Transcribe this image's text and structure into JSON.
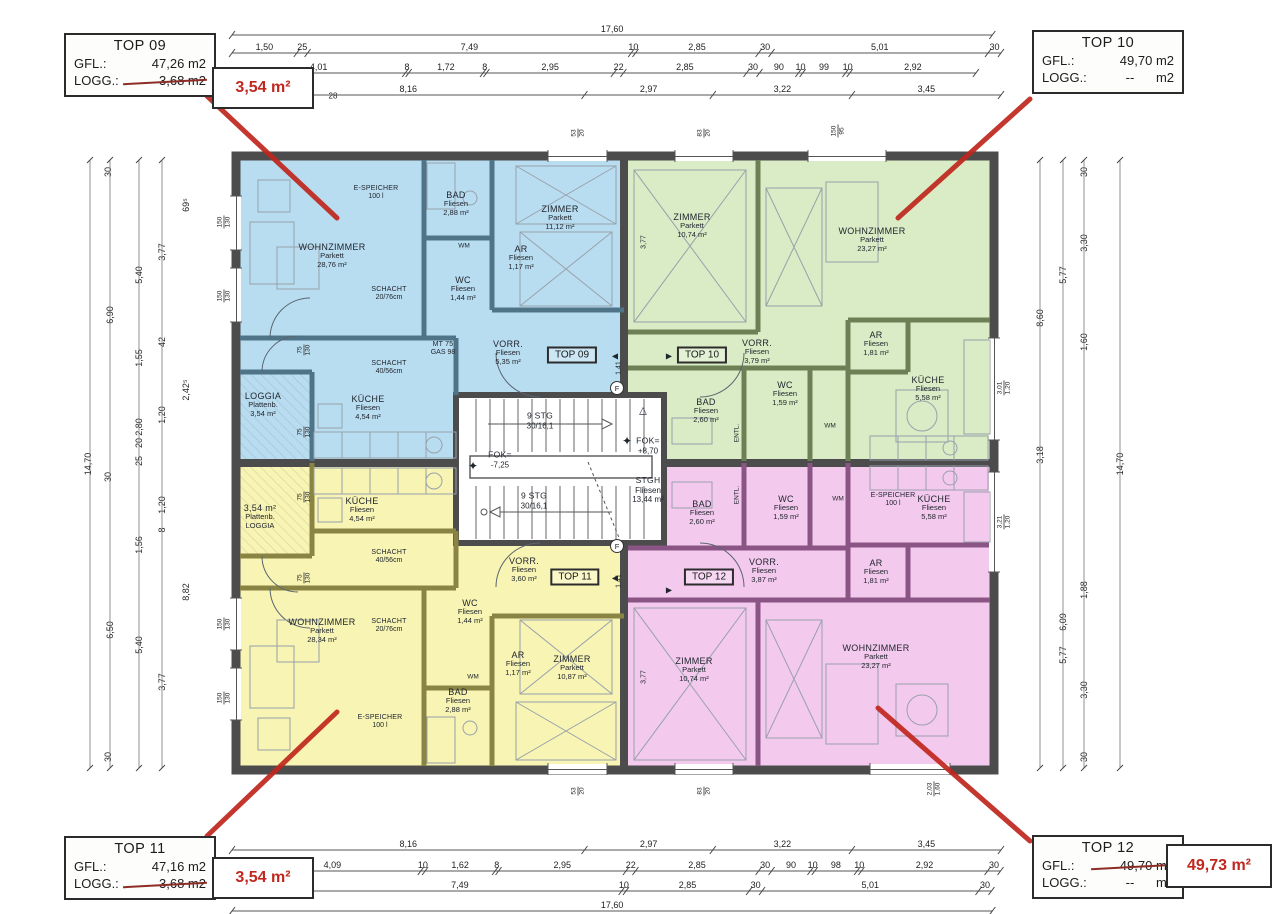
{
  "colors": {
    "accent_red": "#c0271e",
    "blue_fill": "#b9ddf0",
    "green_fill": "#d9ecc5",
    "yellow_fill": "#f8f4b3",
    "pink_fill": "#f4c9ee"
  },
  "annotations": {
    "boxes": [
      {
        "id": "top09",
        "title": "TOP 09",
        "x": 64,
        "y": 33,
        "w": 152,
        "h": 64,
        "rows": [
          {
            "label": "GFL.:",
            "value": "47,26 m2",
            "struck": false
          },
          {
            "label": "LOGG.:",
            "value": "3,68 m2",
            "struck": true
          }
        ]
      },
      {
        "id": "top10",
        "title": "TOP 10",
        "x": 1032,
        "y": 30,
        "w": 152,
        "h": 64,
        "rows": [
          {
            "label": "GFL.:",
            "value": "49,70 m2",
            "struck": false
          },
          {
            "label": "LOGG.:",
            "value": "--      m2",
            "struck": false
          }
        ]
      },
      {
        "id": "top11",
        "title": "TOP 11",
        "x": 64,
        "y": 836,
        "w": 152,
        "h": 64,
        "rows": [
          {
            "label": "GFL.:",
            "value": "47,16 m2",
            "struck": false
          },
          {
            "label": "LOGG.:",
            "value": "3,68 m2",
            "struck": true
          }
        ]
      },
      {
        "id": "top12",
        "title": "TOP 12",
        "x": 1032,
        "y": 835,
        "w": 152,
        "h": 64,
        "rows": [
          {
            "label": "GFL.:",
            "value": "49,70 m2",
            "struck": true
          },
          {
            "label": "LOGG.:",
            "value": "--      m2",
            "struck": false
          }
        ]
      }
    ],
    "red_boxes": [
      {
        "id": "note09",
        "text": "3,54 m²",
        "x": 212,
        "y": 67,
        "w": 102,
        "h": 42
      },
      {
        "id": "note11",
        "text": "3,54 m²",
        "x": 212,
        "y": 857,
        "w": 102,
        "h": 42
      },
      {
        "id": "note12",
        "text": "49,73 m²",
        "x": 1166,
        "y": 844,
        "w": 106,
        "h": 44
      }
    ],
    "red_lines": [
      [
        207,
        96,
        337,
        218
      ],
      [
        1030,
        99,
        898,
        218
      ],
      [
        207,
        836,
        337,
        712
      ],
      [
        1030,
        841,
        878,
        708
      ]
    ]
  },
  "plan": {
    "unit_signs": [
      {
        "text": "TOP 09",
        "x": 572,
        "y": 355
      },
      {
        "text": "TOP 10",
        "x": 702,
        "y": 355
      },
      {
        "text": "TOP 11",
        "x": 575,
        "y": 577
      },
      {
        "text": "TOP 12",
        "x": 709,
        "y": 577
      }
    ],
    "f_letter": "F",
    "f_markers": [
      [
        617,
        388
      ],
      [
        617,
        546
      ]
    ],
    "labels": [
      {
        "lines": [
          "WOHNZIMMER",
          "Parkett",
          "28,76 m²"
        ],
        "x": 332,
        "y": 256
      },
      {
        "lines": [
          "ZIMMER",
          "Parkett",
          "11,12 m²"
        ],
        "x": 560,
        "y": 218
      },
      {
        "lines": [
          "BAD",
          "Fliesen",
          "2,88 m²"
        ],
        "x": 456,
        "y": 204
      },
      {
        "lines": [
          "AR",
          "Fliesen",
          "1,17 m²"
        ],
        "x": 521,
        "y": 258
      },
      {
        "lines": [
          "WC",
          "Fliesen",
          "1,44 m²"
        ],
        "x": 463,
        "y": 289
      },
      {
        "lines": [
          "VORR.",
          "Fliesen",
          "5,35 m²"
        ],
        "x": 508,
        "y": 353
      },
      {
        "lines": [
          "KÜCHE",
          "Fliesen",
          "4,54 m²"
        ],
        "x": 368,
        "y": 408
      },
      {
        "lines": [
          "LOGGIA",
          "Plattenb.",
          "3,54 m²"
        ],
        "x": 263,
        "y": 405
      },
      {
        "lines": [
          "ZIMMER",
          "Parkett",
          "10,74 m²"
        ],
        "x": 692,
        "y": 226
      },
      {
        "lines": [
          "WOHNZIMMER",
          "Parkett",
          "23,27 m²"
        ],
        "x": 872,
        "y": 240
      },
      {
        "lines": [
          "VORR.",
          "Fliesen",
          "3,79 m²"
        ],
        "x": 757,
        "y": 352
      },
      {
        "lines": [
          "BAD",
          "Fliesen",
          "2,60 m²"
        ],
        "x": 706,
        "y": 411
      },
      {
        "lines": [
          "WC",
          "Fliesen",
          "1,59 m²"
        ],
        "x": 785,
        "y": 394
      },
      {
        "lines": [
          "AR",
          "Fliesen",
          "1,81 m²"
        ],
        "x": 876,
        "y": 344
      },
      {
        "lines": [
          "KÜCHE",
          "Fliesen",
          "5,58 m²"
        ],
        "x": 928,
        "y": 389
      },
      {
        "lines": [
          "WOHNZIMMER",
          "Parkett",
          "28,34 m²"
        ],
        "x": 322,
        "y": 631
      },
      {
        "lines": [
          "ZIMMER",
          "Parkett",
          "10,87 m²"
        ],
        "x": 572,
        "y": 668
      },
      {
        "lines": [
          "BAD",
          "Fliesen",
          "2,88 m²"
        ],
        "x": 458,
        "y": 701
      },
      {
        "lines": [
          "AR",
          "Fliesen",
          "1,17 m²"
        ],
        "x": 518,
        "y": 664
      },
      {
        "lines": [
          "WC",
          "Fliesen",
          "1,44 m²"
        ],
        "x": 470,
        "y": 612
      },
      {
        "lines": [
          "VORR.",
          "Fliesen",
          "3,60 m²"
        ],
        "x": 524,
        "y": 570
      },
      {
        "lines": [
          "KÜCHE",
          "Fliesen",
          "4,54 m²"
        ],
        "x": 362,
        "y": 510
      },
      {
        "lines": [
          "3,54 m²",
          "Plattenb.",
          "LOGGIA"
        ],
        "x": 260,
        "y": 517
      },
      {
        "lines": [
          "ZIMMER",
          "Parkett",
          "10,74 m²"
        ],
        "x": 694,
        "y": 670
      },
      {
        "lines": [
          "WOHNZIMMER",
          "Parkett",
          "23,27 m²"
        ],
        "x": 876,
        "y": 657
      },
      {
        "lines": [
          "VORR.",
          "Fliesen",
          "3,87 m²"
        ],
        "x": 764,
        "y": 571
      },
      {
        "lines": [
          "BAD",
          "Fliesen",
          "2,60 m²"
        ],
        "x": 702,
        "y": 513
      },
      {
        "lines": [
          "WC",
          "Fliesen",
          "1,59 m²"
        ],
        "x": 786,
        "y": 508
      },
      {
        "lines": [
          "AR",
          "Fliesen",
          "1,81 m²"
        ],
        "x": 876,
        "y": 572
      },
      {
        "lines": [
          "KÜCHE",
          "Fliesen",
          "5,58 m²"
        ],
        "x": 934,
        "y": 508
      },
      {
        "lines": [
          "9 STG",
          "30/16,1"
        ],
        "x": 540,
        "y": 421,
        "cls": "stair"
      },
      {
        "lines": [
          "9 STG",
          "30/16,1"
        ],
        "x": 534,
        "y": 501,
        "cls": "stair"
      },
      {
        "lines": [
          "FOK=",
          "-7,25"
        ],
        "x": 500,
        "y": 460,
        "cls": "stair"
      },
      {
        "lines": [
          "FOK=",
          "+8,70"
        ],
        "x": 648,
        "y": 446,
        "cls": "stair"
      },
      {
        "lines": [
          "STGH",
          "Fliesen",
          "13,44 m²"
        ],
        "x": 648,
        "y": 490,
        "cls": "stair"
      },
      {
        "lines": [
          "E-SPEICHER",
          "100 l"
        ],
        "x": 376,
        "y": 193,
        "cls": "tiny"
      },
      {
        "lines": [
          "E-SPEICHER",
          "100 l"
        ],
        "x": 380,
        "y": 722,
        "cls": "tiny"
      },
      {
        "lines": [
          "E-SPEICHER",
          "100 l"
        ],
        "x": 893,
        "y": 500,
        "cls": "tiny"
      },
      {
        "lines": [
          "SCHACHT",
          "20/76cm"
        ],
        "x": 389,
        "y": 294,
        "cls": "tiny"
      },
      {
        "lines": [
          "SCHACHT",
          "40/56cm"
        ],
        "x": 389,
        "y": 368,
        "cls": "tiny"
      },
      {
        "lines": [
          "SCHACHT",
          "40/56cm"
        ],
        "x": 389,
        "y": 557,
        "cls": "tiny"
      },
      {
        "lines": [
          "SCHACHT",
          "20/76cm"
        ],
        "x": 389,
        "y": 626,
        "cls": "tiny"
      },
      {
        "lines": [
          "MT 75",
          "GAS 98"
        ],
        "x": 443,
        "y": 349,
        "cls": "tiny"
      }
    ],
    "small": [
      {
        "t": "ENTL.",
        "x": 737,
        "y": 433,
        "rot": -90,
        "fs": 6.5
      },
      {
        "t": "ENTL.",
        "x": 737,
        "y": 495,
        "rot": -90,
        "fs": 6.5
      },
      {
        "t": "WM",
        "x": 464,
        "y": 246,
        "fs": 6.5
      },
      {
        "t": "WM",
        "x": 473,
        "y": 677,
        "fs": 6.5
      },
      {
        "t": "WM",
        "x": 830,
        "y": 426,
        "fs": 6.5
      },
      {
        "t": "WM",
        "x": 838,
        "y": 499,
        "fs": 6.5
      },
      {
        "t": "28",
        "x": 333,
        "y": 96,
        "fs": 8
      },
      {
        "t": "1,41",
        "x": 619,
        "y": 368,
        "rot": -90,
        "fs": 7
      },
      {
        "t": "1,41",
        "x": 619,
        "y": 581,
        "rot": -90,
        "fs": 7
      },
      {
        "t": "3,77",
        "x": 644,
        "y": 242,
        "rot": -90,
        "fs": 7
      },
      {
        "t": "3,77",
        "x": 644,
        "y": 677,
        "rot": -90,
        "fs": 7
      },
      {
        "t": "△",
        "x": 643,
        "y": 411,
        "fs": 10
      },
      {
        "t": "✦",
        "x": 473,
        "y": 466,
        "fs": 12
      },
      {
        "t": "✦",
        "x": 627,
        "y": 441,
        "fs": 12
      },
      {
        "t": "◀",
        "x": 615,
        "y": 356,
        "fs": 8
      },
      {
        "t": "▶",
        "x": 669,
        "y": 356,
        "fs": 8
      },
      {
        "t": "◀",
        "x": 615,
        "y": 578,
        "fs": 8
      },
      {
        "t": "▶",
        "x": 669,
        "y": 590,
        "fs": 8
      }
    ],
    "window_labels": [
      {
        "lines": [
          "150",
          "130"
        ],
        "x": 224,
        "y": 222
      },
      {
        "lines": [
          "150",
          "130"
        ],
        "x": 224,
        "y": 296
      },
      {
        "lines": [
          "150",
          "130"
        ],
        "x": 224,
        "y": 624
      },
      {
        "lines": [
          "150",
          "130"
        ],
        "x": 224,
        "y": 698
      },
      {
        "lines": [
          "3,01",
          "1,20"
        ],
        "x": 1004,
        "y": 388
      },
      {
        "lines": [
          "3,21",
          "1,20"
        ],
        "x": 1004,
        "y": 522
      },
      {
        "lines": [
          "53",
          "20"
        ],
        "x": 578,
        "y": 133
      },
      {
        "lines": [
          "83",
          "20"
        ],
        "x": 704,
        "y": 133
      },
      {
        "lines": [
          "150",
          "95"
        ],
        "x": 838,
        "y": 131
      },
      {
        "lines": [
          "53",
          "20"
        ],
        "x": 578,
        "y": 791
      },
      {
        "lines": [
          "83",
          "20"
        ],
        "x": 704,
        "y": 791
      },
      {
        "lines": [
          "2,03",
          "1,60"
        ],
        "x": 934,
        "y": 789
      },
      {
        "lines": [
          "75",
          "130"
        ],
        "x": 304,
        "y": 350
      },
      {
        "lines": [
          "75",
          "130"
        ],
        "x": 304,
        "y": 432
      },
      {
        "lines": [
          "75",
          "130"
        ],
        "x": 304,
        "y": 497
      },
      {
        "lines": [
          "75",
          "130"
        ],
        "x": 304,
        "y": 578
      }
    ]
  },
  "dimensions": {
    "k": 43.2,
    "x0": 232,
    "h_rows": [
      {
        "y": 30,
        "segs": [
          {
            "t": "17,60",
            "v": 17.6
          }
        ]
      },
      {
        "y": 48,
        "segs": [
          {
            "t": "1,50",
            "v": 1.5
          },
          {
            "t": "25",
            "v": 0.25
          },
          {
            "t": "7,49",
            "v": 7.49
          },
          {
            "t": "10",
            "v": 0.1
          },
          {
            "t": "2,85",
            "v": 2.85
          },
          {
            "t": "30",
            "v": 0.3
          },
          {
            "t": "5,01",
            "v": 5.01
          },
          {
            "t": "30",
            "v": 0.3
          }
        ]
      },
      {
        "y": 68,
        "segs": [
          {
            "t": "4,01",
            "v": 4.01
          },
          {
            "t": "8",
            "v": 0.08
          },
          {
            "t": "1,72",
            "v": 1.72
          },
          {
            "t": "8",
            "v": 0.08
          },
          {
            "t": "2,95",
            "v": 2.95
          },
          {
            "t": "22",
            "v": 0.22
          },
          {
            "t": "2,85",
            "v": 2.85
          },
          {
            "t": "30",
            "v": 0.3
          },
          {
            "t": "90",
            "v": 0.9
          },
          {
            "t": "10",
            "v": 0.1
          },
          {
            "t": "99",
            "v": 0.99
          },
          {
            "t": "10",
            "v": 0.1
          },
          {
            "t": "2,92",
            "v": 2.92
          }
        ]
      },
      {
        "y": 90,
        "segs": [
          {
            "t": "8,16",
            "v": 8.16
          },
          {
            "t": "2,97",
            "v": 2.97
          },
          {
            "t": "3,22",
            "v": 3.22
          },
          {
            "t": "3,45",
            "v": 3.45
          }
        ]
      },
      {
        "y": 845,
        "segs": [
          {
            "t": "8,16",
            "v": 8.16
          },
          {
            "t": "2,97",
            "v": 2.97
          },
          {
            "t": "3,22",
            "v": 3.22
          },
          {
            "t": "3,45",
            "v": 3.45
          }
        ]
      },
      {
        "y": 866,
        "segs": [
          {
            "t": "28",
            "v": 0.28
          },
          {
            "t": "4,09",
            "v": 4.09
          },
          {
            "t": "10",
            "v": 0.1
          },
          {
            "t": "1,62",
            "v": 1.62
          },
          {
            "t": "8",
            "v": 0.08
          },
          {
            "t": "2,95",
            "v": 2.95
          },
          {
            "t": "22",
            "v": 0.22
          },
          {
            "t": "2,85",
            "v": 2.85
          },
          {
            "t": "30",
            "v": 0.3
          },
          {
            "t": "90",
            "v": 0.9
          },
          {
            "t": "10",
            "v": 0.1
          },
          {
            "t": "98",
            "v": 0.98
          },
          {
            "t": "10",
            "v": 0.1
          },
          {
            "t": "2,92",
            "v": 2.92
          },
          {
            "t": "30",
            "v": 0.3
          }
        ]
      },
      {
        "y": 886,
        "segs": [
          {
            "t": "",
            "v": 1.28
          },
          {
            "t": "25",
            "v": 0.25
          },
          {
            "t": "7,49",
            "v": 7.49
          },
          {
            "t": "10",
            "v": 0.1
          },
          {
            "t": "2,85",
            "v": 2.85
          },
          {
            "t": "30",
            "v": 0.3
          },
          {
            "t": "5,01",
            "v": 5.01
          },
          {
            "t": "30",
            "v": 0.3
          }
        ]
      },
      {
        "y": 906,
        "segs": [
          {
            "t": "17,60",
            "v": 17.6
          }
        ]
      }
    ],
    "v_lines": [
      90,
      110,
      139,
      162,
      1040,
      1063,
      1084,
      1120
    ],
    "v_labels": [
      {
        "t": "30",
        "x": 108,
        "y": 172
      },
      {
        "t": "69⁵",
        "x": 186,
        "y": 205
      },
      {
        "t": "3,77",
        "x": 162,
        "y": 252
      },
      {
        "t": "5,40",
        "x": 139,
        "y": 275
      },
      {
        "t": "6,90",
        "x": 110,
        "y": 315
      },
      {
        "t": "42",
        "x": 162,
        "y": 342
      },
      {
        "t": "1,55",
        "x": 139,
        "y": 358
      },
      {
        "t": "2,42⁵",
        "x": 186,
        "y": 390
      },
      {
        "t": "1,20",
        "x": 162,
        "y": 415
      },
      {
        "t": "2,80",
        "x": 139,
        "y": 427
      },
      {
        "t": "20",
        "x": 139,
        "y": 443
      },
      {
        "t": "25",
        "x": 139,
        "y": 461
      },
      {
        "t": "14,70",
        "x": 88,
        "y": 464
      },
      {
        "t": "30",
        "x": 108,
        "y": 477
      },
      {
        "t": "1,20",
        "x": 162,
        "y": 505
      },
      {
        "t": "8",
        "x": 162,
        "y": 530
      },
      {
        "t": "1,56",
        "x": 139,
        "y": 545
      },
      {
        "t": "8,82",
        "x": 186,
        "y": 592
      },
      {
        "t": "6,50",
        "x": 110,
        "y": 630
      },
      {
        "t": "5,40",
        "x": 139,
        "y": 645
      },
      {
        "t": "3,77",
        "x": 162,
        "y": 682
      },
      {
        "t": "30",
        "x": 108,
        "y": 757
      },
      {
        "t": "30",
        "x": 1084,
        "y": 172
      },
      {
        "t": "3,30",
        "x": 1084,
        "y": 243
      },
      {
        "t": "5,77",
        "x": 1063,
        "y": 275
      },
      {
        "t": "8,60",
        "x": 1040,
        "y": 318
      },
      {
        "t": "1,60",
        "x": 1084,
        "y": 342
      },
      {
        "t": "3,18",
        "x": 1040,
        "y": 455
      },
      {
        "t": "14,70",
        "x": 1120,
        "y": 464
      },
      {
        "t": "1,88",
        "x": 1084,
        "y": 590
      },
      {
        "t": "6,09",
        "x": 1063,
        "y": 622
      },
      {
        "t": "5,77",
        "x": 1063,
        "y": 655
      },
      {
        "t": "3,30",
        "x": 1084,
        "y": 690
      },
      {
        "t": "30",
        "x": 1084,
        "y": 757
      }
    ]
  }
}
